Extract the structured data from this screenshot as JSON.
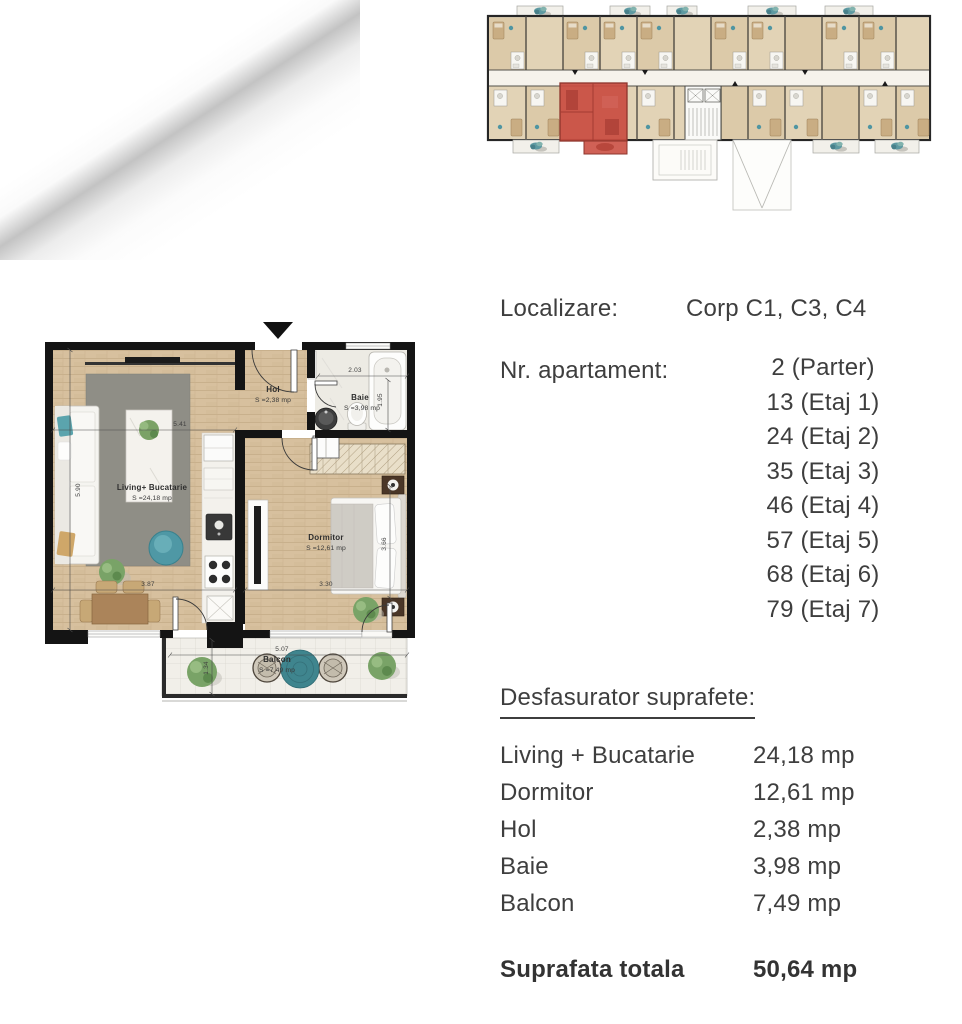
{
  "colors": {
    "text": "#3e3e3e",
    "highlight_red": "#c84c41",
    "wall_black": "#141414",
    "wood_floor": "#d7c09e",
    "accent_teal": "#4f98a5"
  },
  "floor_plan": {
    "rooms": [
      {
        "name": "Living+ Bucatarie",
        "area": "S =24,18 mp"
      },
      {
        "name": "Dormitor",
        "area": "S =12,61 mp"
      },
      {
        "name": "Hol",
        "area": "S =2,38 mp"
      },
      {
        "name": "Baie",
        "area": "S =3,98 mp"
      },
      {
        "name": "Balcon",
        "area": "S =7,49 mp"
      }
    ],
    "dimensions": {
      "living_width": "5.41",
      "living_depth": "5.90",
      "living_bottom": "3.87",
      "dormitor_width": "3.30",
      "dormitor_depth": "3.66",
      "baie_width": "2.03",
      "baie_depth": "1.95",
      "balcon_width": "5.07",
      "balcon_depth": "1.34"
    }
  },
  "details": {
    "location": {
      "label": "Localizare:",
      "value": "Corp C1, C3, C4"
    },
    "apartment": {
      "label": "Nr. apartament:",
      "values": [
        "2 (Parter)",
        "13 (Etaj 1)",
        "24 (Etaj 2)",
        "35 (Etaj 3)",
        "46 (Etaj 4)",
        "57 (Etaj 5)",
        "68 (Etaj 6)",
        "79 (Etaj 7)"
      ]
    },
    "surfaces": {
      "title": "Desfasurator suprafete:",
      "rows": [
        {
          "label": "Living + Bucatarie",
          "value": "24,18 mp"
        },
        {
          "label": "Dormitor",
          "value": "12,61 mp"
        },
        {
          "label": "Hol",
          "value": "2,38 mp"
        },
        {
          "label": "Baie",
          "value": "3,98 mp"
        },
        {
          "label": "Balcon",
          "value": "7,49 mp"
        }
      ],
      "total": {
        "label": "Suprafata totala",
        "value": "50,64 mp"
      }
    }
  }
}
